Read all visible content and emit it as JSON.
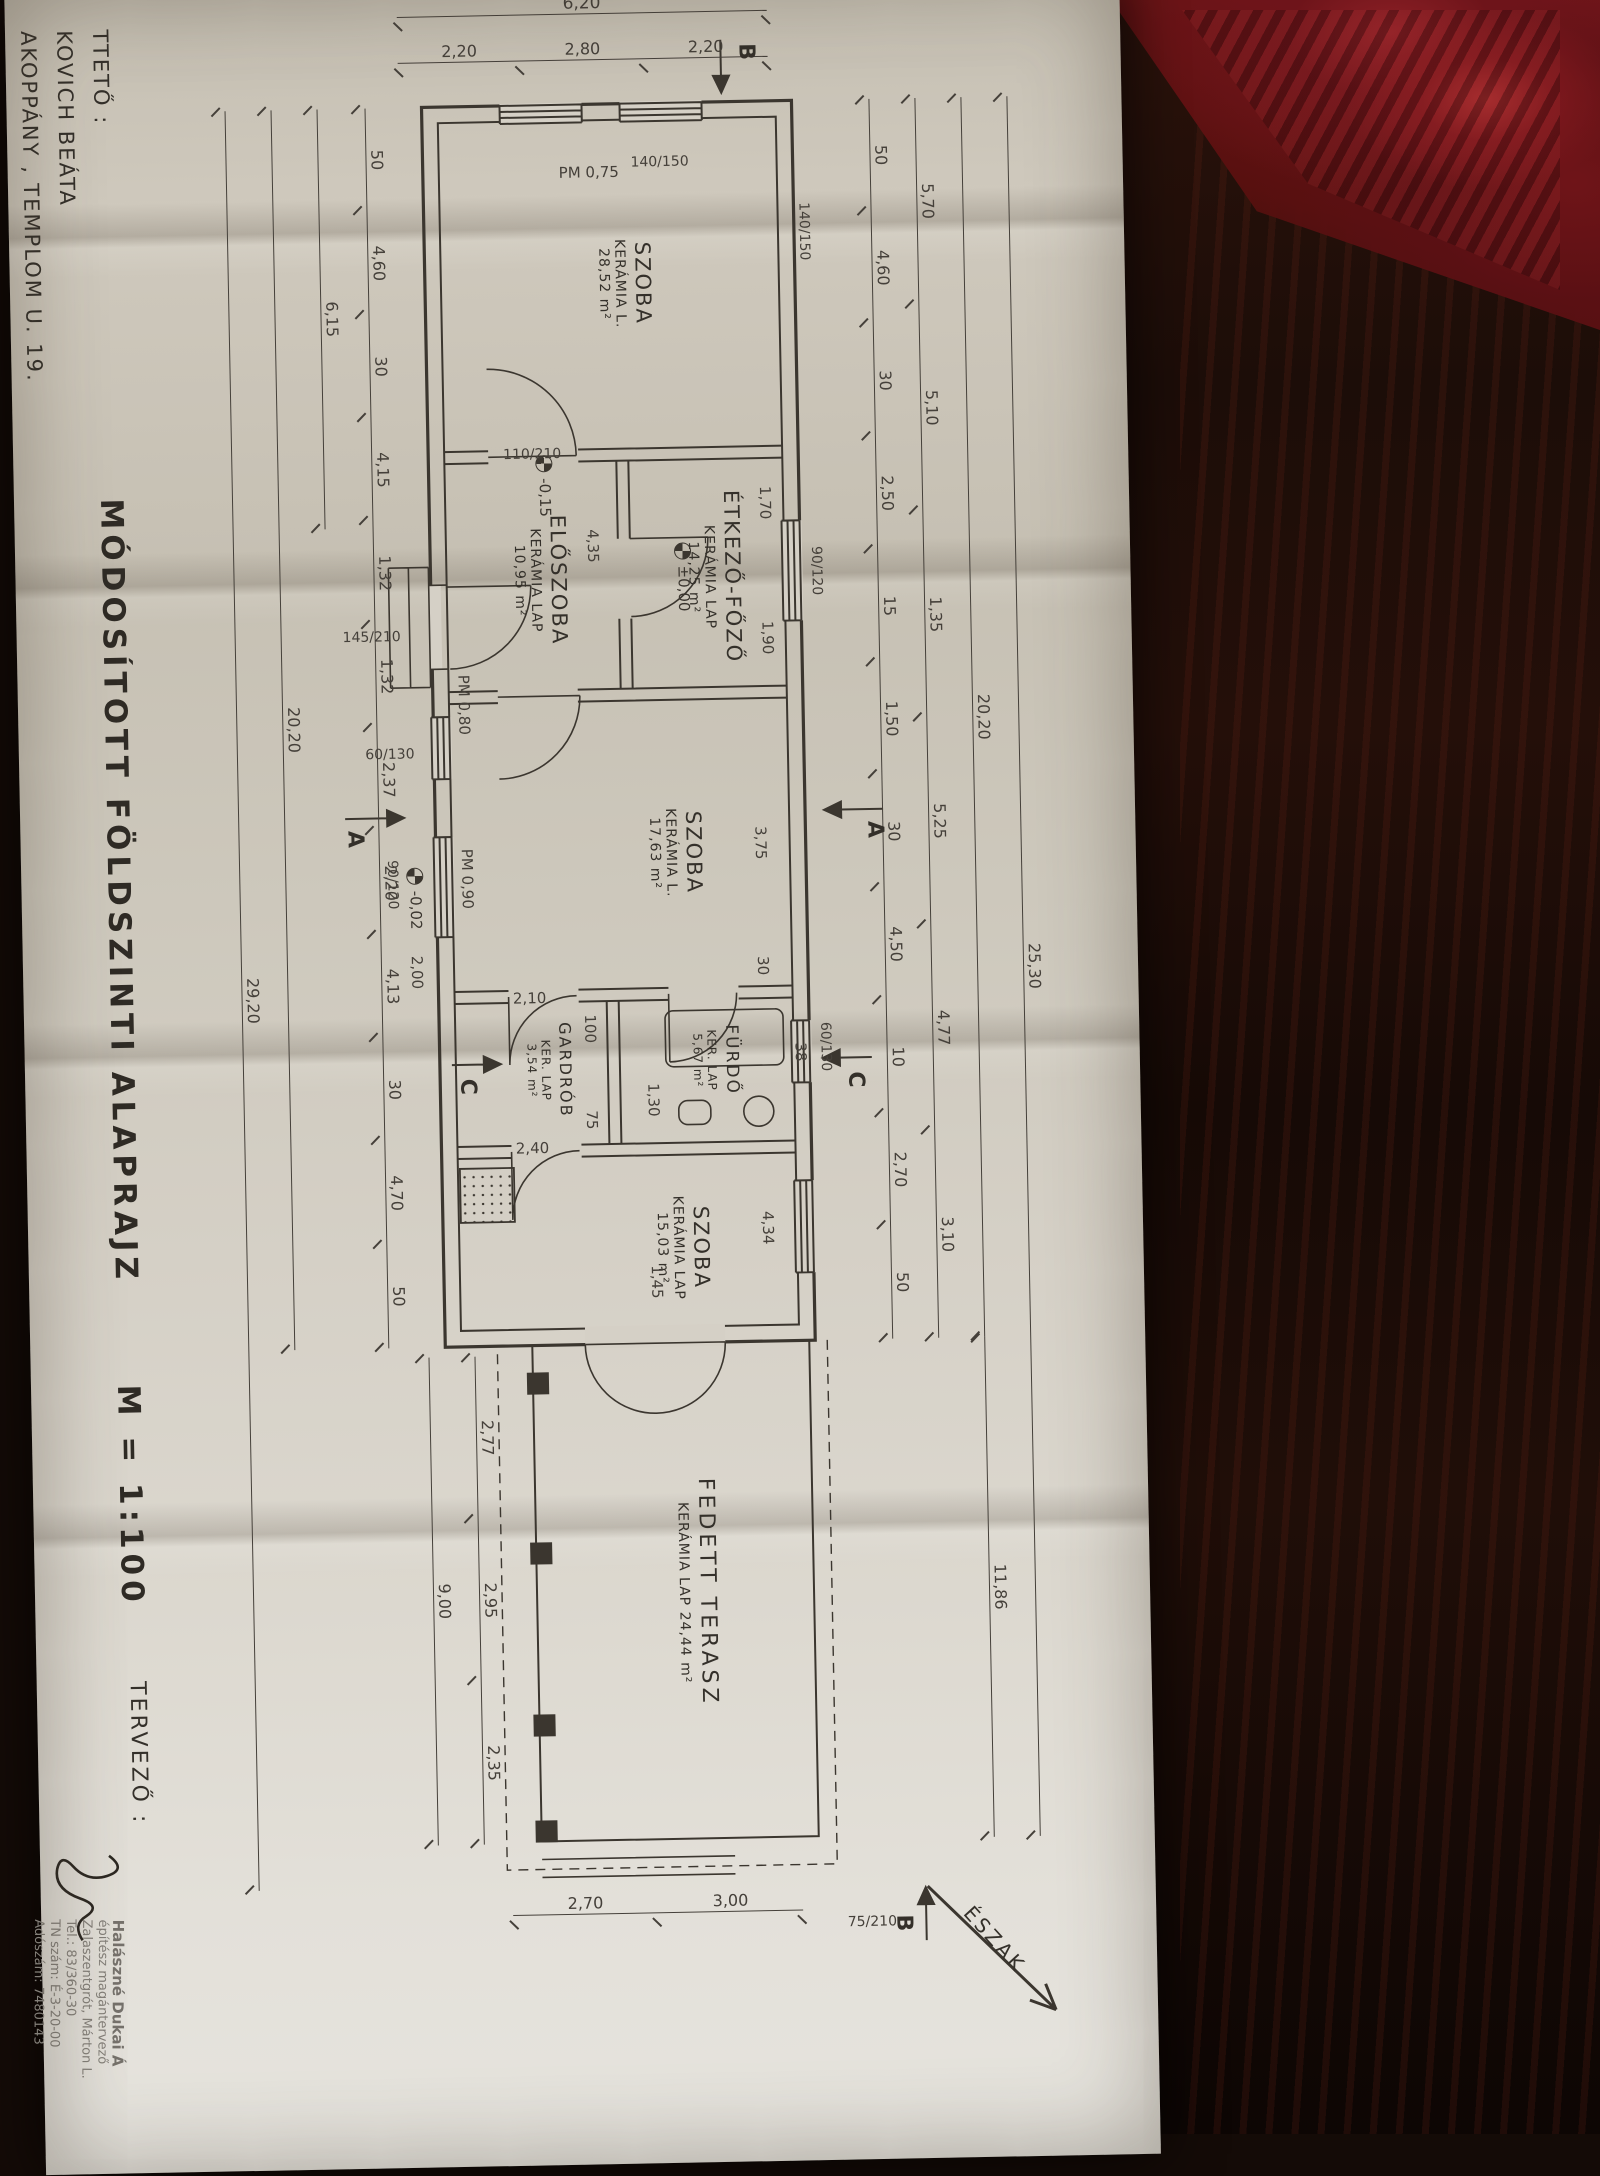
{
  "sheet": {
    "title": "MÓDOSÍTOTT FÖLDSZINTI ALAPRAJZ",
    "scale": "M = 1:100",
    "client_label": "TTETŐ :",
    "client_name": "KOVICH BEÁTA",
    "client_address": "AKOPPÁNY , TEMPLOM U. 19.",
    "designer_label": "TERVEZŐ :",
    "north_label": "ÉSZAK"
  },
  "stamp": {
    "line1": "Halászné Dukai Á",
    "line2": "építész magántervező",
    "line3": "Zalaszentgrót, Márton L.",
    "line4": "Tel.: 83/360-30",
    "line5": "TN szám: É-3-20-00",
    "line6": "Adószám: 7480143"
  },
  "rooms": {
    "szoba1": {
      "name": "SZOBA",
      "finish": "KERÁMIA L.",
      "area": "28,52 m²"
    },
    "eloszoba": {
      "name": "ELŐSZOBA",
      "finish": "KERÁMIA LAP",
      "area": "10,95 m²"
    },
    "etkezo": {
      "name": "ÉTKEZŐ-FŐZŐ",
      "finish": "KERÁMIA LAP",
      "area": "14,25 m²"
    },
    "furdo": {
      "name": "FÜRDŐ",
      "finish": "KER. LAP",
      "area": "5,67 m²"
    },
    "szoba2": {
      "name": "SZOBA",
      "finish": "KERÁMIA L.",
      "area": "17,63 m²"
    },
    "gardrob": {
      "name": "GARDRÓB",
      "finish": "KER. LAP",
      "area": "3,54 m²"
    },
    "szoba3": {
      "name": "SZOBA",
      "finish": "KERÁMIA LAP",
      "area": "15,03 m²"
    },
    "terasz": {
      "name": "FEDETT TERASZ",
      "finish": "KERÁMIA LAP 24,44 m²"
    }
  },
  "levels": {
    "entry": "-0,15",
    "zero": "±0,00",
    "terrace": "-0,02"
  },
  "parapets": {
    "p75": "PM 0,75",
    "p80": "PM 0,80",
    "p90": "PM 0,90"
  },
  "openings": {
    "o1": "140/150",
    "o2": "140/150",
    "o3": "110/210",
    "o4": "145/210",
    "o5": "60/130",
    "o6": "90/120",
    "o7": "90/120",
    "o8": "60/130",
    "o9": "75/210"
  },
  "sections": {
    "a": "A",
    "b": "B",
    "c": "C"
  },
  "dims": {
    "left_total": "6,20",
    "left": [
      "2,20",
      "2,80",
      "2,20"
    ],
    "top_overall": [
      "25,30"
    ],
    "top_house": [
      "20,20"
    ],
    "top_terrace": [
      "11,86"
    ],
    "top_rooms": [
      "5,70",
      "5,10",
      "1,35",
      "5,25",
      "4,77",
      "3,10"
    ],
    "top_detail": [
      "50",
      "4,60",
      "30",
      "2,50",
      "15",
      "1,50",
      "30",
      "4,50",
      "10",
      "2,70",
      "50"
    ],
    "bottom_detail": [
      "50",
      "4,60",
      "30",
      "4,15",
      "1,32",
      "1,32",
      "2,37",
      "2,20",
      "4,13",
      "30",
      "4,70",
      "50"
    ],
    "bottom_left": [
      "6,15"
    ],
    "bottom_house": [
      "20,20"
    ],
    "bottom_overall": [
      "29,20"
    ],
    "terrace_cols": [
      "2,77",
      "2,95",
      "2,35"
    ],
    "terrace_total": [
      "9,00"
    ],
    "right_side": [
      "2,70",
      "3,00"
    ],
    "interior": {
      "eloszoba": "4,35",
      "szoba3": "4,34",
      "szoba2": "3,75",
      "w30": "30",
      "terasz_door": "1,45",
      "furdo": "1,30",
      "etk1": "1,70",
      "etk2": "1,90",
      "g1": "2,40",
      "g2": "2,10",
      "sz2b": "2,00",
      "f38": "38",
      "g75": "75",
      "g100": "100"
    }
  }
}
